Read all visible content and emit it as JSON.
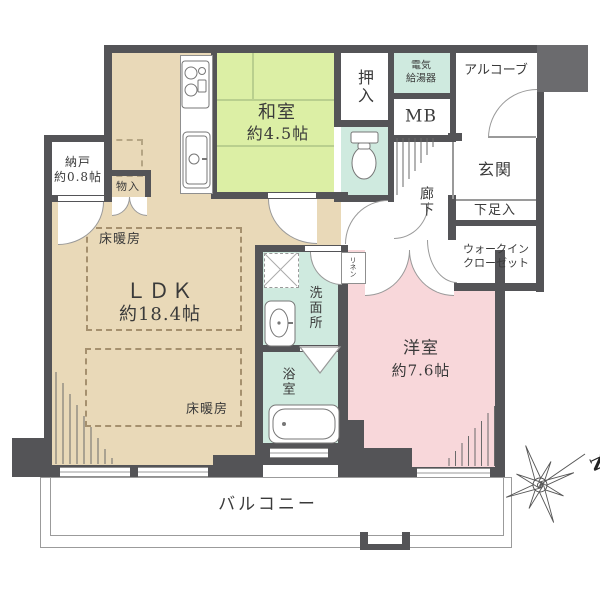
{
  "floorplan": {
    "rooms": {
      "ldk": {
        "name": "ＬＤＫ",
        "size": "約18.4帖"
      },
      "washitsu": {
        "name": "和室",
        "size": "約4.5帖"
      },
      "yoshitsu": {
        "name": "洋室",
        "size": "約7.6帖"
      },
      "nando": {
        "name": "納戸",
        "size": "約0.8帖"
      },
      "oshiire": "押入",
      "monoire": "物入",
      "genkan": "玄関",
      "rouka": "廊下",
      "senmenjo": "洗面所",
      "yokushitsu": "浴室",
      "wic": {
        "line1": "ウォークイン",
        "line2": "クローゼット"
      },
      "getabako": "下足入",
      "alcove": "アルコーブ",
      "mb": "MB",
      "kyutoki": {
        "line1": "電気",
        "line2": "給湯器"
      },
      "linen": "リネン",
      "balcony": "バルコニー"
    },
    "features": {
      "yukadanbo": "床暖房"
    },
    "compass": {
      "north": "N"
    },
    "colors": {
      "wall": "#545457",
      "ldk_floor": "#e9d9b8",
      "tatami": "#dcefa5",
      "wet_area": "#cfeadf",
      "bedroom": "#f8d7da",
      "outside": "#ffffff"
    }
  }
}
